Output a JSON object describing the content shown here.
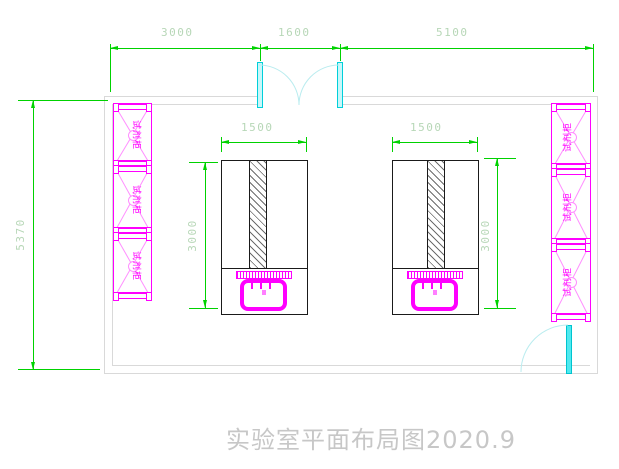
{
  "title": {
    "text": "实验室平面布局图2020.9"
  },
  "dimensions": {
    "top": [
      {
        "label": "3000"
      },
      {
        "label": "1600"
      },
      {
        "label": "5100"
      }
    ],
    "left_wall": {
      "label": "5370"
    },
    "bench_left": {
      "width": "1500",
      "length": "3000"
    },
    "bench_right": {
      "width": "1500",
      "length": "3000"
    }
  },
  "labels": {
    "cabinet": "试剂柜"
  },
  "colors": {
    "dimension_line": "#00d200",
    "dimension_text": "#b7d7b7",
    "cabinet_magenta": "#ff00ff",
    "cabinet_pink": "#ff8fff",
    "door_cyan": "#4fe9ef",
    "door_arc": "#b9ecef",
    "wall_gray": "#d9d9d9",
    "bench_black": "#1a1a1a",
    "title_gray": "#c7c7c7"
  }
}
